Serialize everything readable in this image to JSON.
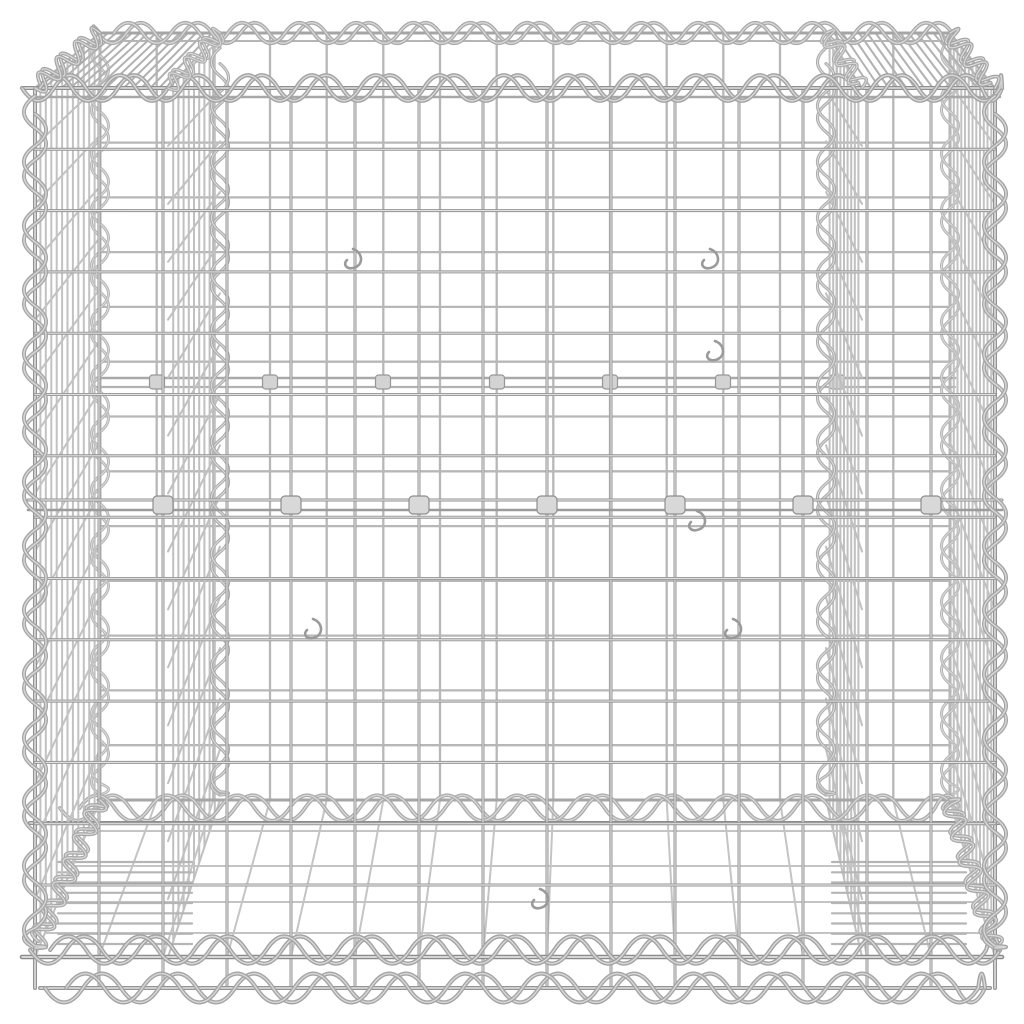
{
  "image": {
    "type": "product-photo",
    "subject": "gabion wire basket",
    "description": "Silver galvanised steel gabion wire-mesh cube basket with spiral-wound edge binders, internal divider panels, clip fasteners and wire hooks, viewed from the front at a slightly elevated angle on a plain white background",
    "background": "#ffffff"
  },
  "palette": {
    "background": "#ffffff",
    "highlight": "#e0e0e0",
    "wire_dark": "#8a8a8a",
    "wire_mid": "#a8a8a8",
    "wire_light": "#c6c6c6",
    "clip_fill": "#d8d8d8"
  },
  "scene": {
    "canvas": {
      "w": 1024,
      "h": 1024
    },
    "layers": [
      {
        "t": "grid",
        "name": "back-panel-grid",
        "x1": 100,
        "x2": 950,
        "y1": 33,
        "y2": 800,
        "nx": 16,
        "ny": 15,
        "stroke": "#b7b7b7",
        "w": 2.3,
        "hl": false
      },
      {
        "t": "line",
        "name": "back-reinforcement-rail",
        "x1": 95,
        "y1": 378,
        "x2": 955,
        "y2": 378,
        "stroke": "#a9a9a9",
        "w": 2.6,
        "hl": false
      },
      {
        "t": "line",
        "name": "back-reinforcement-rail-2",
        "x1": 95,
        "y1": 387,
        "x2": 955,
        "y2": 387,
        "stroke": "#b2b2b2",
        "w": 2.2,
        "hl": false
      },
      {
        "t": "clips",
        "name": "back-wire-clips",
        "cw": 15,
        "ch": 14,
        "rx": 3,
        "fill": "#d3d3d3",
        "stroke": "#979797",
        "items": [
          [
            157,
            382
          ],
          [
            270,
            382
          ],
          [
            383,
            382
          ],
          [
            497,
            382
          ],
          [
            610,
            382
          ],
          [
            723,
            382
          ],
          [
            837,
            382
          ]
        ]
      },
      {
        "t": "coil",
        "name": "back-left-edge-spiral",
        "x1": 100,
        "y1": 40,
        "x2": 100,
        "y2": 795,
        "wl": 56,
        "amp": 10,
        "w": 3,
        "stroke": "#b5b5b5"
      },
      {
        "t": "coil",
        "name": "back-right-edge-spiral",
        "x1": 950,
        "y1": 40,
        "x2": 950,
        "y2": 795,
        "wl": 56,
        "amp": 10,
        "w": 3,
        "stroke": "#b5b5b5"
      },
      {
        "t": "trap",
        "name": "left-divider-panel",
        "xf": 168,
        "ytf": 88,
        "ybf": 957,
        "xb": 220,
        "ytb": 40,
        "ybb": 800,
        "nV": 9,
        "nH": 15,
        "stroke": "#c0c0c0",
        "w": 2
      },
      {
        "t": "trap",
        "name": "right-divider-panel",
        "xf": 862,
        "ytf": 88,
        "ybf": 957,
        "xb": 826,
        "ytb": 40,
        "ybb": 800,
        "nV": 9,
        "nH": 15,
        "stroke": "#c0c0c0",
        "w": 2
      },
      {
        "t": "coil",
        "name": "left-divider-back-spiral",
        "x1": 220,
        "y1": 48,
        "x2": 220,
        "y2": 795,
        "wl": 56,
        "amp": 10,
        "w": 3.2,
        "stroke": "#acacac"
      },
      {
        "t": "coil",
        "name": "right-divider-back-spiral",
        "x1": 826,
        "y1": 48,
        "x2": 826,
        "y2": 795,
        "wl": 56,
        "amp": 10,
        "w": 3.2,
        "stroke": "#acacac"
      },
      {
        "t": "fan",
        "name": "floor-mesh",
        "xb1": 100,
        "xb2": 950,
        "yb": 800,
        "xf1": 35,
        "xf2": 995,
        "yf": 957,
        "nLong": 16,
        "trans": [
          800,
          831,
          866,
          902,
          933
        ],
        "stroke": "#c4c4c4",
        "w": 2
      },
      {
        "t": "line",
        "name": "back-bottom-rail",
        "x1": 98,
        "y1": 800,
        "x2": 952,
        "y2": 800,
        "stroke": "#a6a6a6",
        "w": 3,
        "hl": false
      },
      {
        "t": "coil",
        "name": "floor-joint-spiral",
        "x1": 60,
        "y1": 808,
        "x2": 960,
        "y2": 808,
        "wl": 70,
        "amp": 15,
        "w": 3.8,
        "stroke": "#ababab"
      },
      {
        "t": "line",
        "name": "floor-joint-rail",
        "x1": 30,
        "y1": 823,
        "x2": 1000,
        "y2": 823,
        "stroke": "#8c8c8c",
        "w": 4,
        "hl": true
      },
      {
        "t": "ladder",
        "name": "left-corner-base-mesh",
        "x1": 58,
        "x2": 192,
        "y1": 862,
        "y2": 944,
        "n": 9,
        "stroke": "#b5b5b5",
        "w": 2.2
      },
      {
        "t": "ladder",
        "name": "right-corner-base-mesh",
        "x1": 832,
        "x2": 966,
        "y1": 862,
        "y2": 944,
        "n": 9,
        "stroke": "#b5b5b5",
        "w": 2.2
      },
      {
        "t": "trap",
        "name": "left-side-panel",
        "xf": 35,
        "ytf": 88,
        "ybf": 957,
        "xb": 100,
        "ytb": 33,
        "ybb": 800,
        "nV": 11,
        "nH": 15,
        "stroke": "#c2c2c2",
        "w": 2
      },
      {
        "t": "trap",
        "name": "right-side-panel",
        "xf": 995,
        "ytf": 88,
        "ybf": 957,
        "xb": 950,
        "ytb": 33,
        "ybb": 800,
        "nV": 11,
        "nH": 15,
        "stroke": "#c2c2c2",
        "w": 2
      },
      {
        "t": "hatch",
        "name": "left-top-corner-hatch",
        "a": [
          35,
          88,
          100,
          33
        ],
        "b": [
          168,
          88,
          220,
          33
        ],
        "n": 15,
        "stroke": "#b2b2b2",
        "w": 2
      },
      {
        "t": "hatch",
        "name": "right-top-corner-hatch",
        "a": [
          995,
          88,
          950,
          33
        ],
        "b": [
          862,
          88,
          826,
          33
        ],
        "n": 15,
        "stroke": "#b2b2b2",
        "w": 2
      },
      {
        "t": "grid",
        "name": "front-panel-grid",
        "x1": 35,
        "x2": 995,
        "y1": 88,
        "y2": 885,
        "vy2": 988,
        "nx": 16,
        "ny": 14,
        "stroke": "#949494",
        "w": 3,
        "hl": true
      },
      {
        "t": "line",
        "name": "front-reinforcement-rail",
        "x1": 28,
        "y1": 500,
        "x2": 1002,
        "y2": 500,
        "stroke": "#8f8f8f",
        "w": 3,
        "hl": true
      },
      {
        "t": "line",
        "name": "front-reinforcement-rail-2",
        "x1": 28,
        "y1": 510,
        "x2": 1002,
        "y2": 510,
        "stroke": "#9c9c9c",
        "w": 2.6,
        "hl": false
      },
      {
        "t": "clips",
        "name": "front-wire-clips",
        "cw": 20,
        "ch": 18,
        "rx": 4,
        "fill": "#d8d8d8",
        "stroke": "#8f8f8f",
        "items": [
          [
            163,
            505
          ],
          [
            291,
            505
          ],
          [
            419,
            505
          ],
          [
            547,
            505
          ],
          [
            675,
            505
          ],
          [
            803,
            505
          ],
          [
            931,
            505
          ]
        ]
      },
      {
        "t": "line",
        "name": "front-bottom-rail",
        "x1": 22,
        "y1": 957,
        "x2": 1002,
        "y2": 957,
        "stroke": "#8a8a8a",
        "w": 4.5,
        "hl": true
      },
      {
        "t": "coil",
        "name": "front-bottom-spiral",
        "x1": 30,
        "y1": 950,
        "x2": 1000,
        "y2": 950,
        "wl": 72,
        "amp": 16,
        "w": 4.2,
        "stroke": "#a2a2a2"
      },
      {
        "t": "line",
        "name": "base-rail",
        "x1": 40,
        "y1": 988,
        "x2": 990,
        "y2": 988,
        "stroke": "#949494",
        "w": 4,
        "hl": true
      },
      {
        "t": "coil",
        "name": "base-spiral",
        "x1": 45,
        "y1": 988,
        "x2": 985,
        "y2": 988,
        "wl": 76,
        "amp": 17,
        "w": 4.2,
        "stroke": "#a4a4a4"
      },
      {
        "t": "coil",
        "name": "bottom-left-corner-spiral",
        "x1": 35,
        "y1": 948,
        "x2": 100,
        "y2": 800,
        "wl": 26,
        "amp": 11,
        "w": 3.8,
        "stroke": "#a8a8a8"
      },
      {
        "t": "coil",
        "name": "bottom-right-corner-spiral",
        "x1": 995,
        "y1": 948,
        "x2": 950,
        "y2": 800,
        "wl": 26,
        "amp": 11,
        "w": 3.8,
        "stroke": "#a8a8a8"
      },
      {
        "t": "line",
        "name": "back-rim-rail",
        "x1": 98,
        "y1": 33,
        "x2": 952,
        "y2": 33,
        "stroke": "#a5a5a5",
        "w": 3,
        "hl": false
      },
      {
        "t": "line",
        "name": "back-rim-rail-2",
        "x1": 98,
        "y1": 41,
        "x2": 952,
        "y2": 41,
        "stroke": "#b5b5b5",
        "w": 2,
        "hl": false
      },
      {
        "t": "coil",
        "name": "back-rim-spiral",
        "x1": 98,
        "y1": 33,
        "x2": 952,
        "y2": 33,
        "wl": 57,
        "amp": 12,
        "w": 3.8,
        "stroke": "#a9a9a9"
      },
      {
        "t": "line",
        "name": "front-rim-rail",
        "x1": 22,
        "y1": 88,
        "x2": 1002,
        "y2": 88,
        "stroke": "#8f8f8f",
        "w": 4,
        "hl": true
      },
      {
        "t": "line",
        "name": "front-rim-rail-2",
        "x1": 30,
        "y1": 97,
        "x2": 1000,
        "y2": 97,
        "stroke": "#a8a8a8",
        "w": 2.4,
        "hl": false
      },
      {
        "t": "coil",
        "name": "front-rim-spiral",
        "x1": 22,
        "y1": 88,
        "x2": 1002,
        "y2": 88,
        "wl": 64,
        "amp": 15,
        "w": 4.2,
        "stroke": "#a2a2a2"
      },
      {
        "t": "coil",
        "name": "top-left-corner-spiral",
        "x1": 35,
        "y1": 88,
        "x2": 100,
        "y2": 33,
        "wl": 24,
        "amp": 11,
        "w": 3.8,
        "stroke": "#a5a5a5"
      },
      {
        "t": "coil",
        "name": "top-right-corner-spiral",
        "x1": 995,
        "y1": 88,
        "x2": 950,
        "y2": 33,
        "wl": 24,
        "amp": 11,
        "w": 3.8,
        "stroke": "#a5a5a5"
      },
      {
        "t": "coil",
        "name": "left-divider-top-spiral",
        "x1": 168,
        "y1": 88,
        "x2": 220,
        "y2": 33,
        "wl": 22,
        "amp": 10,
        "w": 3.4,
        "stroke": "#ababab"
      },
      {
        "t": "coil",
        "name": "right-divider-top-spiral",
        "x1": 862,
        "y1": 88,
        "x2": 826,
        "y2": 33,
        "wl": 22,
        "amp": 10,
        "w": 3.4,
        "stroke": "#ababab"
      },
      {
        "t": "coil",
        "name": "front-left-edge-spiral",
        "x1": 35,
        "y1": 96,
        "x2": 35,
        "y2": 948,
        "wl": 64,
        "amp": 13,
        "w": 4,
        "stroke": "#a5a5a5"
      },
      {
        "t": "coil",
        "name": "front-right-edge-spiral",
        "x1": 995,
        "y1": 96,
        "x2": 995,
        "y2": 948,
        "wl": 64,
        "amp": 13,
        "w": 4,
        "stroke": "#a5a5a5"
      },
      {
        "t": "hooks",
        "name": "wire-hooks",
        "stroke": "#9a9a9a",
        "w": 2.6,
        "items": [
          [
            353,
            265
          ],
          [
            710,
            265
          ],
          [
            715,
            357
          ],
          [
            697,
            527
          ],
          [
            313,
            635
          ],
          [
            733,
            635
          ],
          [
            540,
            905
          ]
        ]
      }
    ]
  }
}
